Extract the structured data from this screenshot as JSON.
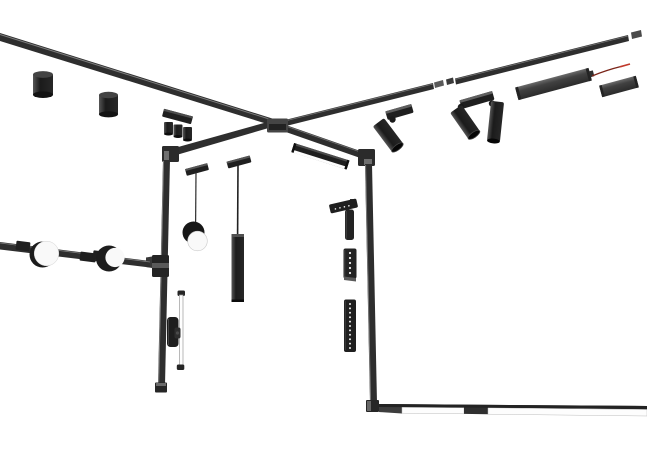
{
  "scene": {
    "title": "Exploded 3D render of a black magnetic track lighting system on a white background",
    "background": "#ffffff"
  },
  "colors": {
    "track": "#2e2e2e",
    "fixture": "#1f1f1f",
    "connector": "#4a4a4a",
    "connector_light": "#777777",
    "edge_highlight": "#858585",
    "diffuser": "#fdfdfd",
    "disk_face": "#f9f9f9",
    "wire": "#7a2418",
    "wire_tip": "#c0392b",
    "led_dot": "#f0f0f0"
  },
  "leds": {
    "folding_head": 4,
    "grid_module": 5,
    "linear_module": 11
  },
  "components": [
    {
      "id": "ceiling-track-left",
      "label": "ceiling track rail (left run)"
    },
    {
      "id": "ceiling-track-right",
      "label": "ceiling track rail (right run)"
    },
    {
      "id": "cross-connector",
      "label": "X cross track connector"
    },
    {
      "id": "surface-cylinder-downlight",
      "label": "surface cylinder downlight",
      "count": 2
    },
    {
      "id": "triple-spot-bar",
      "label": "triple head track spot bar"
    },
    {
      "id": "angled-track-spotlight",
      "label": "adjustable track spotlight",
      "count": 3
    },
    {
      "id": "driver-module",
      "label": "track power driver module with feed wire",
      "count": 2
    },
    {
      "id": "pendant-sphere",
      "label": "sphere pendant light"
    },
    {
      "id": "pendant-tube",
      "label": "cylinder tube pendant light"
    },
    {
      "id": "linear-diffuser-light",
      "label": "linear diffuser track light",
      "count": 2
    },
    {
      "id": "wall-track-horizontal",
      "label": "wall track rail (horizontal)"
    },
    {
      "id": "disk-wall-light",
      "label": "round disk wall light",
      "count": 2
    },
    {
      "id": "wall-tube-light",
      "label": "slim tube wall light"
    },
    {
      "id": "track-adapter-block",
      "label": "track adapter block"
    },
    {
      "id": "folding-wall-spot",
      "label": "folding linear wall spot"
    },
    {
      "id": "grid-dot-module",
      "label": "LED grid dot module"
    },
    {
      "id": "linear-grid-module",
      "label": "linear LED grid module"
    },
    {
      "id": "track-end-cap",
      "label": "track end cap",
      "count": 2
    }
  ]
}
